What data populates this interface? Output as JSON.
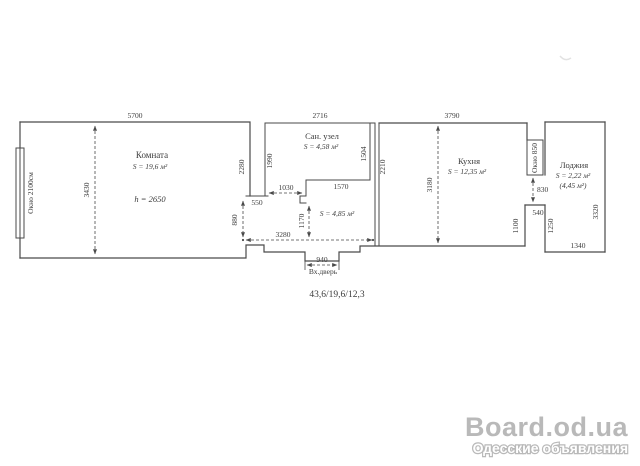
{
  "plan": {
    "summary": "43,6/19,6/12,3",
    "rooms": {
      "living": {
        "name": "Комната",
        "area": "S = 19,6 м²",
        "height": "h = 2650"
      },
      "bathroom": {
        "name": "Сан. узел",
        "area": "S = 4,58 м²"
      },
      "hallway": {
        "area": "S = 4,85 м²"
      },
      "kitchen": {
        "name": "Кухня",
        "area": "S = 12,35 м²"
      },
      "loggia": {
        "name": "Лоджия",
        "area": "S = 2,22 м²",
        "area_alt": "(4,45 м²)"
      }
    },
    "windows": {
      "living_window": "Окно 2100см",
      "kitchen_window": "Окно 850"
    },
    "entrance": {
      "label": "Вх.дверь"
    },
    "dims": {
      "living_width": "5700",
      "living_depth": "3430",
      "living_wall_right": "2280",
      "living_door": "880",
      "wall_stub": "550",
      "bath_width": "2716",
      "bath_left": "1990",
      "bath_right": "1504",
      "bath_bottom": "1570",
      "bath_door": "1030",
      "hall_depth": "1170",
      "hall_width": "3280",
      "hall_kitchen_wall": "2210",
      "entrance_width": "940",
      "kitchen_width": "3790",
      "kitchen_depth": "3180",
      "kitchen_wall_lower": "1100",
      "balcony_door": "830",
      "step": "540",
      "loggia_wall_left": "1250",
      "loggia_bottom": "1340",
      "loggia_height": "3320"
    }
  },
  "watermark": {
    "site": "Board.od.ua",
    "tagline": "Одесские объявления"
  },
  "colors": {
    "line": "#4a4a4a",
    "watermark_gray": "#b9b9b9",
    "background": "#ffffff"
  }
}
